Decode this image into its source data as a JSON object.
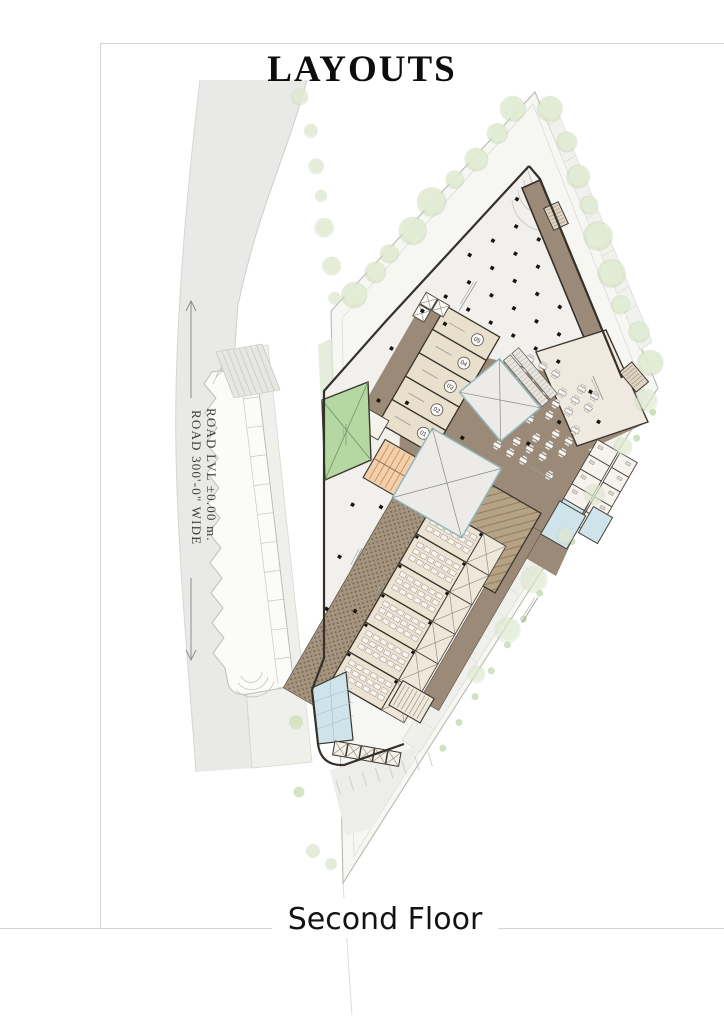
{
  "sheet": {
    "title": "LAYOUTS",
    "floor_label": "Second Floor"
  },
  "road": {
    "label_wide": "ROAD  300'-0\"  WIDE",
    "label_level": "ROAD LVL ±0.00 m."
  },
  "plan": {
    "units": [
      "05",
      "04",
      "03",
      "02",
      "01"
    ]
  },
  "colors": {
    "wall_dark": "#35302a",
    "corridor_brown": "#9c8a78",
    "marble_floor": "#f2f0ec",
    "room_beige": "#e9dfcd",
    "green_room": "#b5d8a3",
    "stair_orange": "#f4cfa9",
    "cutout_border": "#8fb6ba",
    "toilet_blue": "#cfe3ea",
    "tree_green": "#dde8d0",
    "road_gray": "#e9e9e7",
    "site_gray": "#f0f0ed"
  }
}
